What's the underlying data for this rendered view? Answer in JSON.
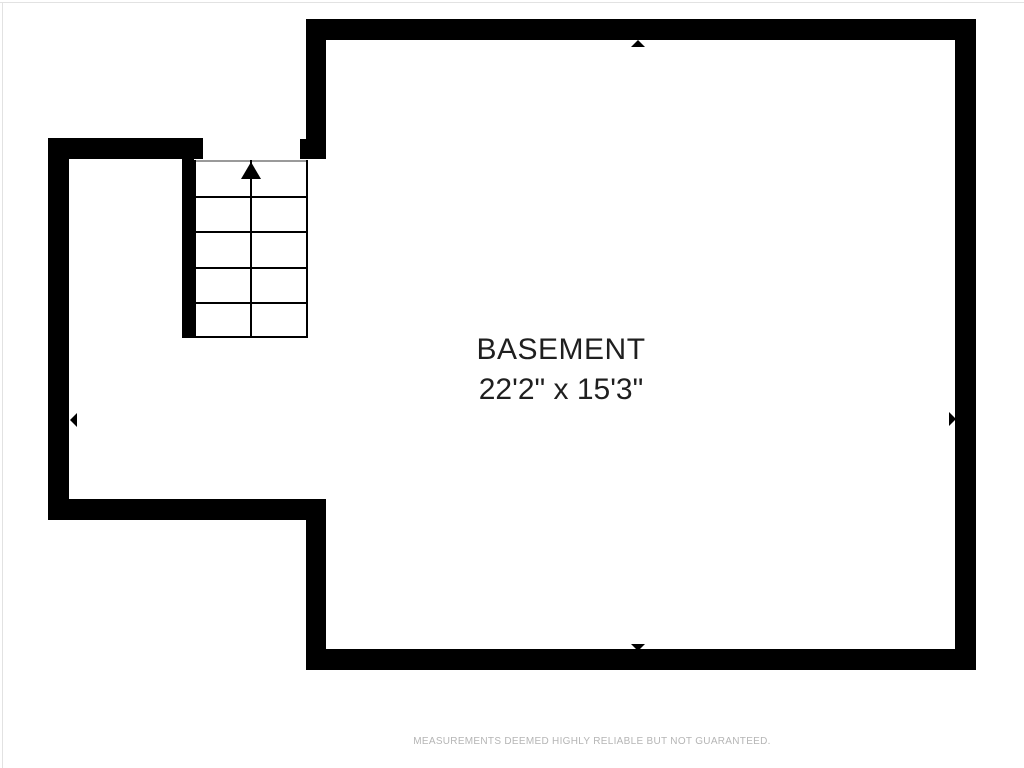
{
  "plan": {
    "room": {
      "name": "BASEMENT",
      "dimensions": "22'2\" x 15'3\""
    },
    "stairs": {
      "rows": 5,
      "columns": 2,
      "direction": "up"
    },
    "markers": [
      "up",
      "down",
      "left",
      "right"
    ],
    "disclaimer": "MEASUREMENTS DEEMED HIGHLY RELIABLE BUT NOT GUARANTEED."
  },
  "colors": {
    "wall": "#000000",
    "background": "#ffffff",
    "room_label": "#1f1f1f",
    "stair_opening_line": "#9a9a9a",
    "disclaimer_text": "#b5b5b5"
  }
}
